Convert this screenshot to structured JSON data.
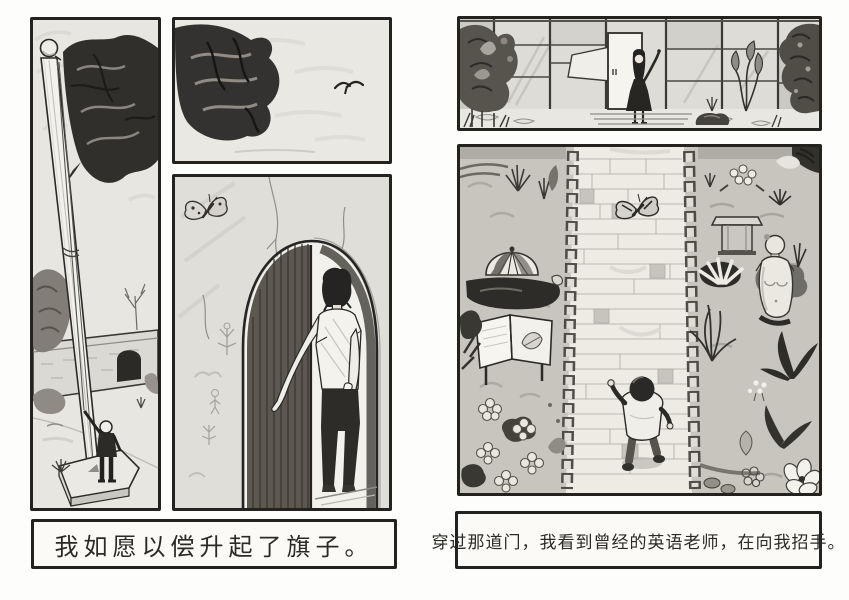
{
  "meta": {
    "title": "Hand-drawn two-page comic spread in pencil"
  },
  "colors": {
    "paper": "#fdfdfb",
    "ink": "#23221f",
    "pencil_light": "#e7e6e1",
    "pencil_dark": "#312f2b"
  },
  "left_page": {
    "caption": "我如愿以偿升起了旗子。",
    "panels": [
      {
        "id": "flag-raising",
        "alt": "Child at the base of a tall flagpole raising a dark flag; wall with arched gate, trees and grass behind"
      },
      {
        "id": "flag-closeup",
        "alt": "Close-up corner of the dark flag waving in a light sky with a small bird flying"
      },
      {
        "id": "arched-doorway",
        "alt": "Boy seen from behind stepping through a tall arched doorway with a half-open dark door; butterfly on the cracked wall"
      }
    ]
  },
  "right_page": {
    "caption": "穿过那道门，我看到曾经的英语老师，在向我招手。",
    "panels": [
      {
        "id": "teacher-waving",
        "alt": "Woman in a dark dress waving in front of a glass-walled building with a white door, dense plants at both sides"
      },
      {
        "id": "garden-path",
        "alt": "Overhead view of the child walking up a stone-edged brick path between flower beds with a butterfly, sign board and classical statue"
      }
    ]
  }
}
